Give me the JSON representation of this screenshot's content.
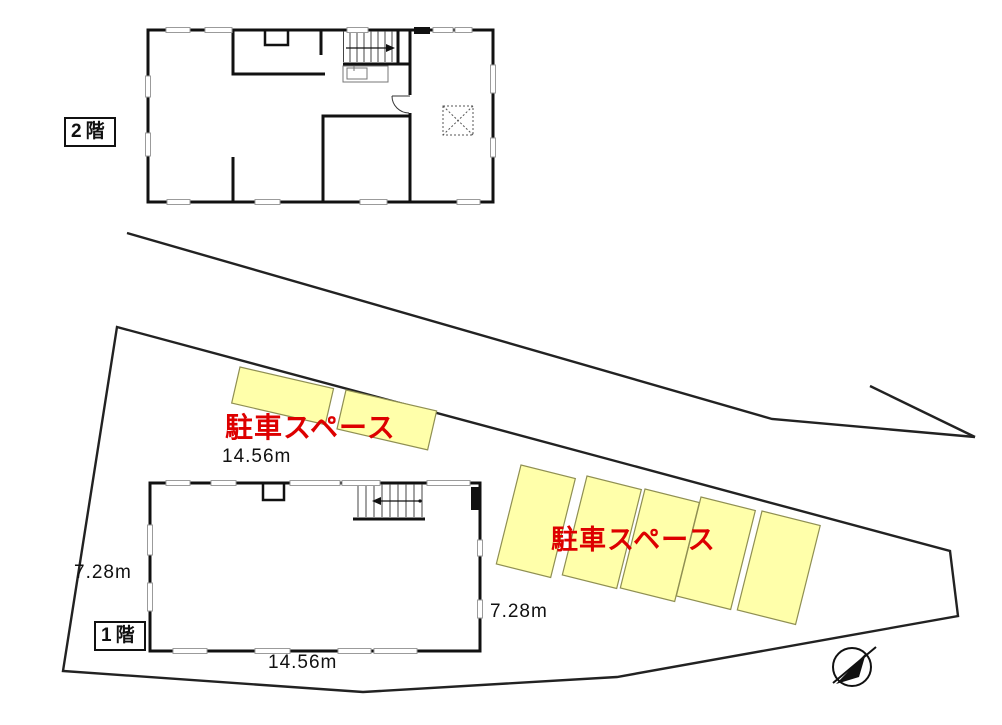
{
  "document": {
    "type": "floor-and-site-plan",
    "background": "#ffffff"
  },
  "colors": {
    "wall": "#111111",
    "thin_line": "#444444",
    "window": "#9b9b9b",
    "site_line": "#222222",
    "parking_fill": "#ffffaa",
    "parking_stroke": "#8f8f52",
    "label_red": "#dd0000",
    "text": "#111111"
  },
  "floor2": {
    "tag": "2階"
  },
  "floor1": {
    "tag": "1階"
  },
  "site": {
    "parking_left_label": "駐車スペース",
    "parking_right_label": "駐車スペース",
    "parking_stall_count_left": 2,
    "parking_stall_count_right": 5,
    "dims": {
      "top_width": "14.56m",
      "bottom_width": "14.56m",
      "left_height": "7.28m",
      "right_height": "7.28m"
    }
  },
  "icons": {
    "north_arrow": "north-arrow-icon",
    "stairs_up": "stairs-icon",
    "void_box": "void-dotted-box"
  }
}
